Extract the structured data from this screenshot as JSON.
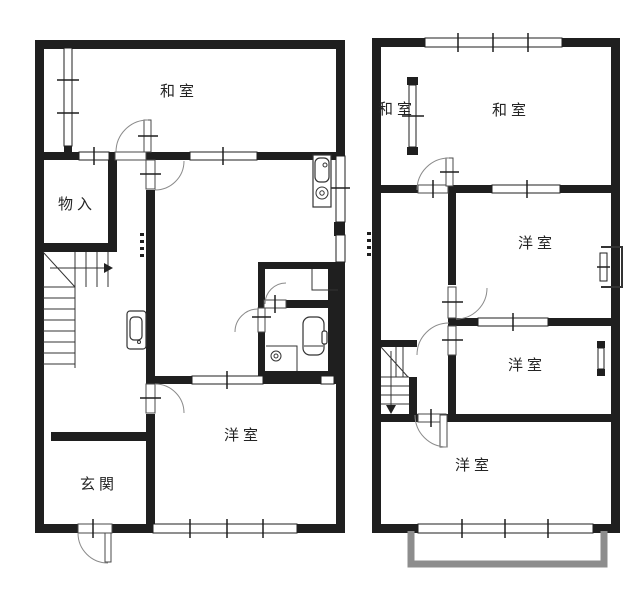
{
  "document": {
    "type": "floor-plan",
    "floors": 2
  },
  "floor1": {
    "rooms": {
      "washitsu": "和室",
      "storage": "物入",
      "entrance": "玄関",
      "western": "洋室"
    }
  },
  "floor2": {
    "rooms": {
      "washitsu_left": "和室",
      "washitsu_right": "和室",
      "western_middle": "洋室",
      "western_lower": "洋室",
      "western_bottom": "洋室"
    }
  },
  "colors": {
    "wall": "#1f1f1f",
    "balcony": "#8d8d8d",
    "background": "#ffffff",
    "line": "#333333"
  }
}
